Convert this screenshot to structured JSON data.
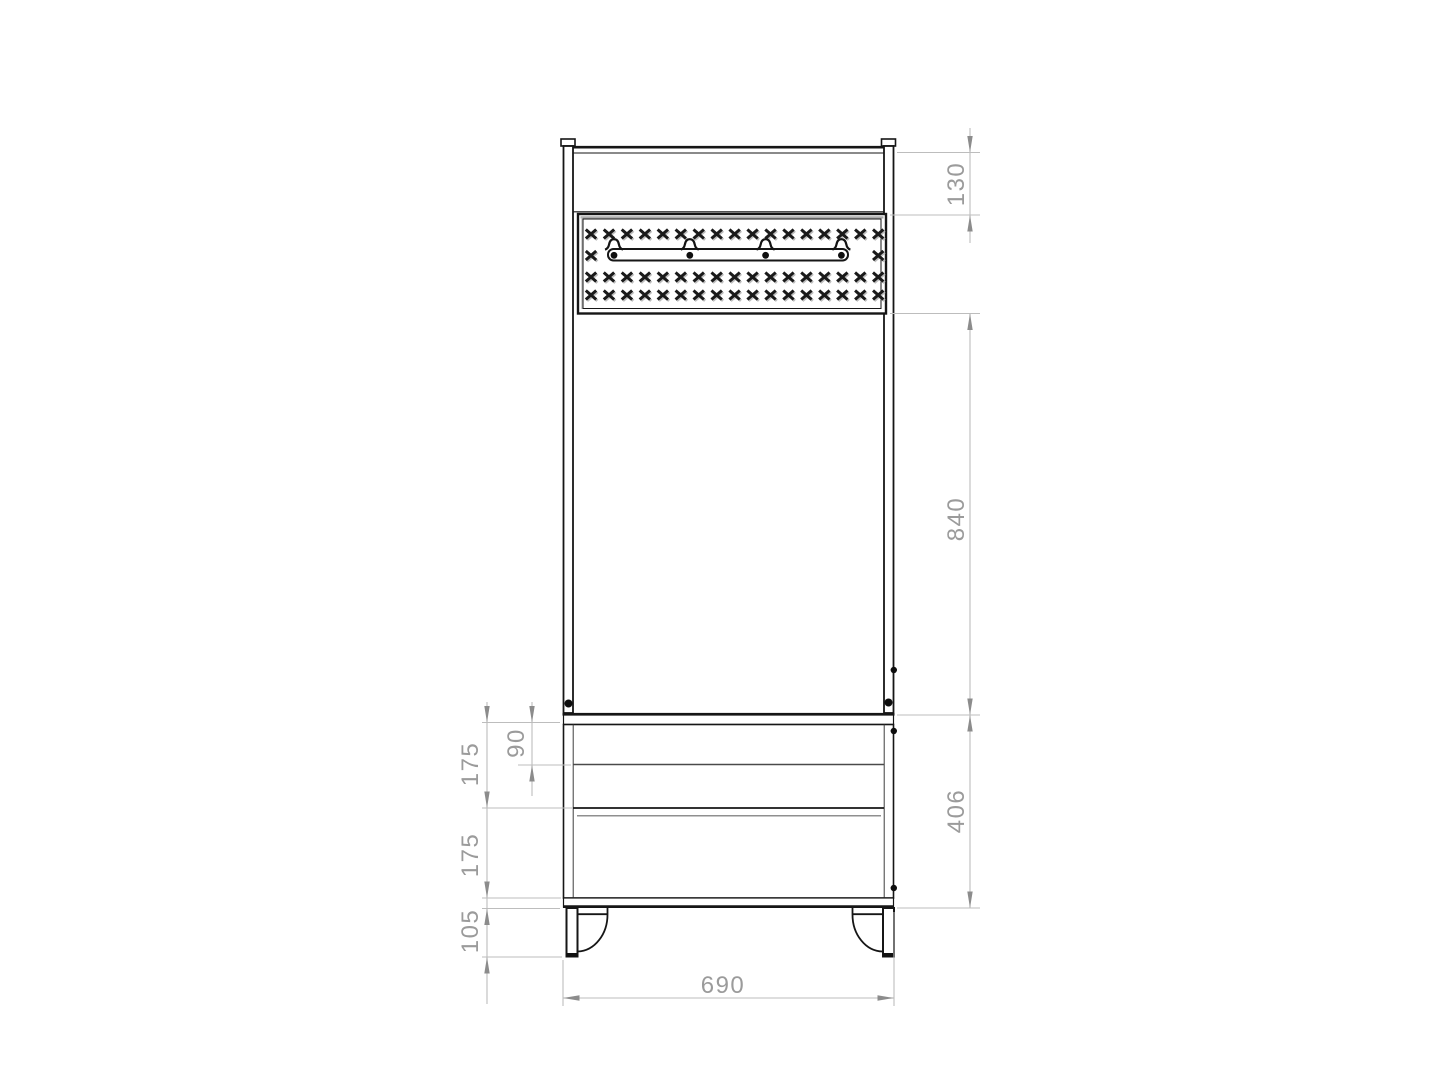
{
  "drawing": {
    "background": "#ffffff",
    "line_color": "#161616",
    "dim_line_color": "#bdbdbd",
    "dim_arrow_color": "#8c8c8c",
    "dim_text_color": "#9b9b9b"
  },
  "dimensions": {
    "d130": {
      "value": "130"
    },
    "d840": {
      "value": "840"
    },
    "d406": {
      "value": "406"
    },
    "d175a": {
      "value": "175"
    },
    "d90": {
      "value": "90"
    },
    "d175b": {
      "value": "175"
    },
    "d105": {
      "value": "105"
    },
    "d690": {
      "value": "690"
    }
  },
  "hook_rail": {
    "hook_count": 4,
    "hook_positions": [
      614,
      689.8,
      765.6,
      841.4
    ]
  },
  "panel_pattern": {
    "columns": 17,
    "x0": 591,
    "dx": 17.95,
    "rows": [
      {
        "y": 234.5,
        "full": true
      },
      {
        "y": 256.0,
        "full": false,
        "indices": [
          0,
          16
        ]
      },
      {
        "y": 277.5,
        "full": true
      },
      {
        "y": 295.5,
        "full": true
      }
    ]
  }
}
